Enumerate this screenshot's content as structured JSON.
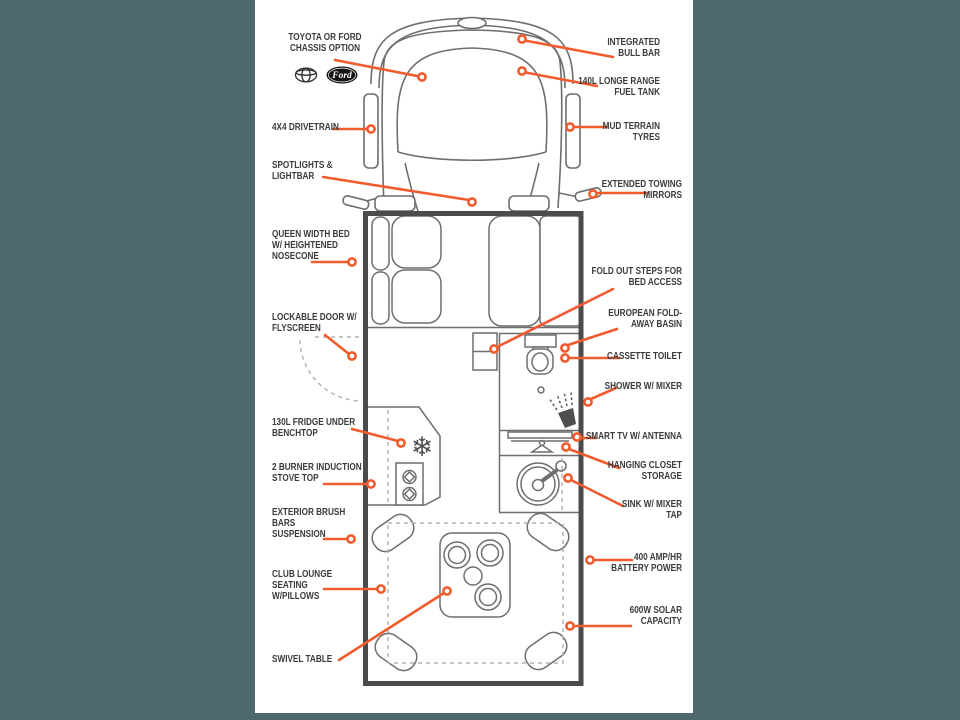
{
  "page": {
    "background_color": "#4e696d",
    "sheet_color": "#ffffff",
    "accent_orange": "#f15b2d",
    "ink_color": "#3b3b3b",
    "line_gray": "#6e6e6e",
    "wall_gray": "#4b4b4b"
  },
  "logos": {
    "ford": "Ford"
  },
  "icons": {
    "snowflake_glyph": "❄"
  },
  "labels": {
    "chassis": "TOYOTA OR FORD\nCHASSIS OPTION",
    "bull_bar": "INTEGRATED\nBULL BAR",
    "fuel_tank": "140L LONGE RANGE\nFUEL TANK",
    "drivetrain": "4X4 DRIVETRAIN",
    "mud_tyres": "MUD TERRAIN\nTYRES",
    "spotlights": "SPOTLIGHTS &\nLIGHTBAR",
    "mirrors": "EXTENDED TOWING\nMIRRORS",
    "queen_bed": "QUEEN WIDTH BED\nW/ HEIGHTENED\nNOSECONE",
    "steps": "FOLD OUT STEPS FOR\nBED ACCESS",
    "basin": "EUROPEAN FOLD-\nAWAY BASIN",
    "toilet": "CASSETTE TOILET",
    "door": "LOCKABLE DOOR W/\nFLYSCREEN",
    "shower": "SHOWER W/ MIXER",
    "tv": "SMART TV W/ ANTENNA",
    "closet": "HANGING CLOSET\nSTORAGE",
    "fridge": "130L FRIDGE UNDER\nBENCHTOP",
    "stove": "2 BURNER INDUCTION\nSTOVE TOP",
    "sink": "SINK W/ MIXER\nTAP",
    "brush_bars": "EXTERIOR BRUSH\nBARS\nSUSPENSION",
    "battery": "400 AMP/HR\nBATTERY POWER",
    "lounge": "CLUB LOUNGE\nSEATING\nW/PILLOWS",
    "solar": "600W SOLAR\nCAPACITY",
    "swivel": "SWIVEL TABLE"
  }
}
